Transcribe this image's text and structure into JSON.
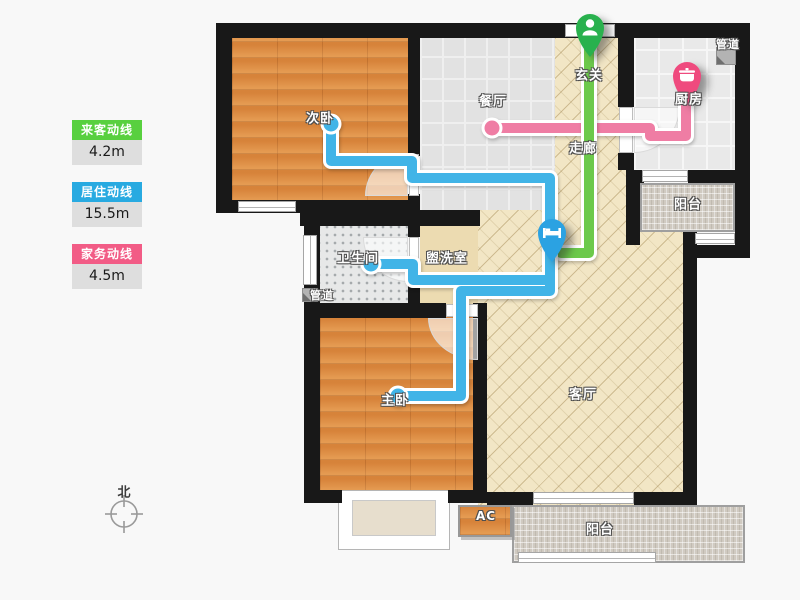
{
  "legend": {
    "items": [
      {
        "label": "来客动线",
        "value": "4.2m",
        "color": "#58d03f"
      },
      {
        "label": "居住动线",
        "value": "15.5m",
        "color": "#28aae1"
      },
      {
        "label": "家务动线",
        "value": "4.5m",
        "color": "#f25c86"
      }
    ]
  },
  "rooms": {
    "bedroom2": {
      "label": "次卧"
    },
    "dining": {
      "label": "餐厅"
    },
    "entry": {
      "label": "玄关"
    },
    "hallway": {
      "label": "走廊"
    },
    "kitchen": {
      "label": "厨房"
    },
    "pipe_top": {
      "label": "管道"
    },
    "balcony_top": {
      "label": "阳台"
    },
    "bathroom": {
      "label": "卫生间"
    },
    "washroom": {
      "label": "盥洗室"
    },
    "pipe_left": {
      "label": "管道"
    },
    "master": {
      "label": "主卧"
    },
    "living": {
      "label": "客厅"
    },
    "ac": {
      "label": "AC"
    },
    "balcony_bottom": {
      "label": "阳台"
    }
  },
  "compass": {
    "label": "北"
  },
  "flows": {
    "visitor": {
      "color": "#6cc94b",
      "points": "589,46 589,253 561,253"
    },
    "living": {
      "color": "#41b4e7",
      "segments": [
        "331,124 331,161 412,161 412,178 550,178 550,291 461,291 461,396 398,396",
        "371,264 413,264 413,280 547,280"
      ],
      "caps": [
        [
          331,
          124
        ],
        [
          371,
          264
        ],
        [
          398,
          396
        ]
      ]
    },
    "housework": {
      "color": "#ef7da4",
      "points": "686,90 686,136 650,136 650,128 492,128",
      "caps": [
        [
          492,
          128
        ]
      ]
    }
  },
  "markers": [
    {
      "kind": "visitor",
      "icon": "person-icon",
      "color": "#29b14e",
      "x": 590,
      "y": 28
    },
    {
      "kind": "resident",
      "icon": "bed-icon",
      "color": "#2ba2e2",
      "x": 552,
      "y": 233
    },
    {
      "kind": "housework",
      "icon": "pot-icon",
      "color": "#ef4a7e",
      "x": 687,
      "y": 76
    }
  ]
}
